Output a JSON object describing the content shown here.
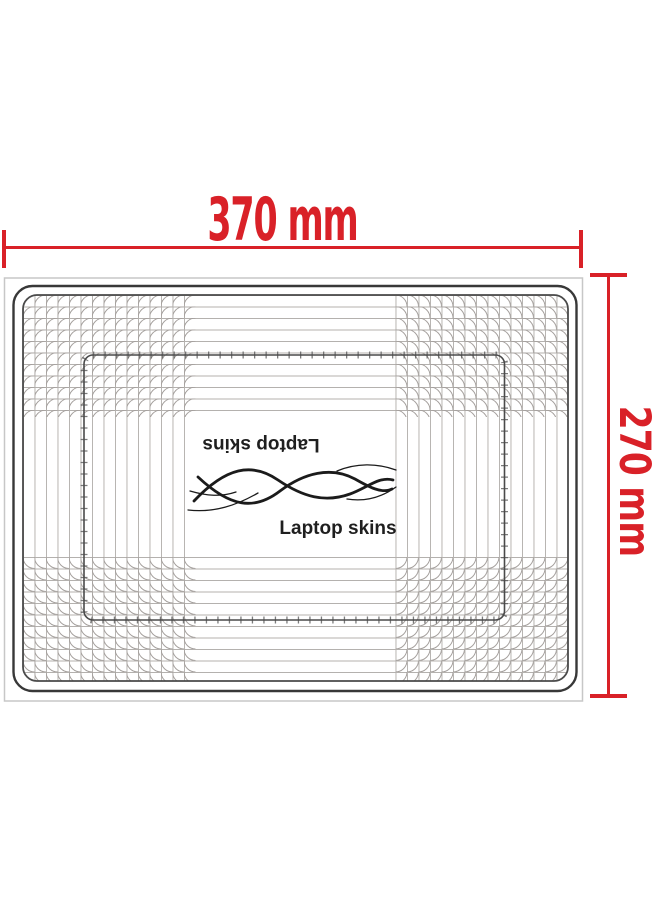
{
  "dimensions": {
    "width": {
      "label": "370 mm"
    },
    "height": {
      "label": "270 mm"
    },
    "line_color": "#d92128"
  },
  "logo": {
    "inverted_text": "Laptop skins",
    "text": "Laptop skins",
    "icon": "wave-swirl-icon",
    "color": "#1f1f1f"
  },
  "template_outline": {
    "outline_color": "#3a3a3a",
    "grid_color": "#b4b1ae",
    "frame_color": "#c7c7c7"
  }
}
